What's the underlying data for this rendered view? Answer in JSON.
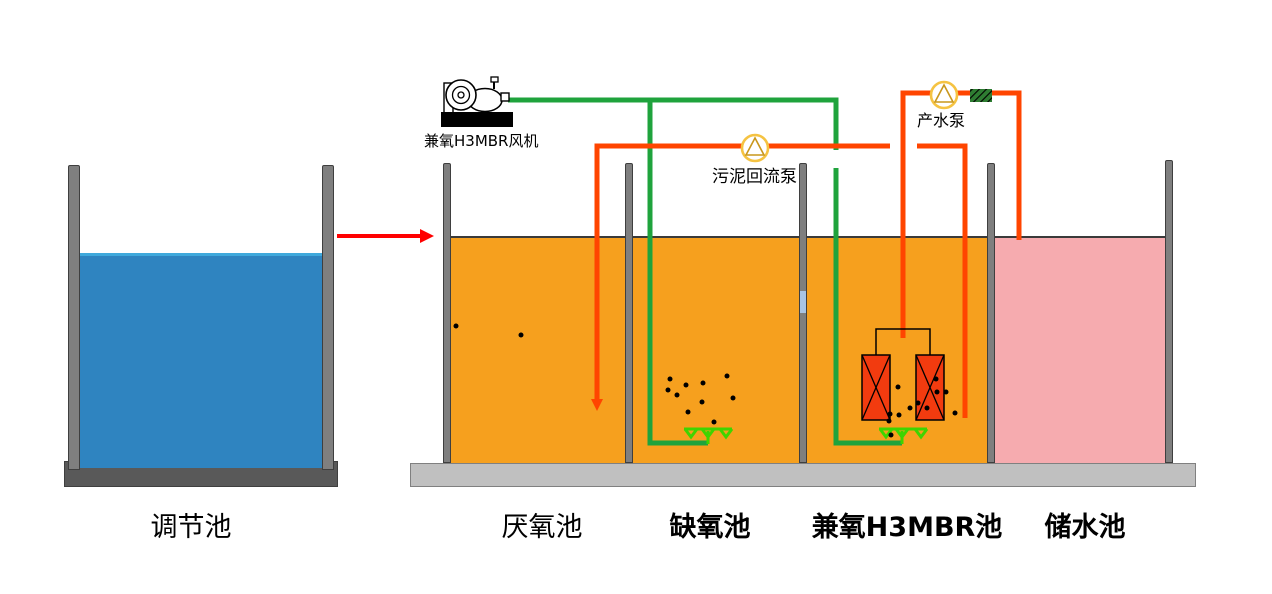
{
  "diagram_title": "兼氧H3MBR污水处理工艺流程图",
  "tanks": [
    {
      "id": "regulating",
      "label": "调节池",
      "liquid_color": "#2f84c0",
      "bold": false
    },
    {
      "id": "anaerobic",
      "label": "厌氧池",
      "liquid_color": "#f6a01e",
      "bold": false
    },
    {
      "id": "anoxic",
      "label": "缺氧池",
      "liquid_color": "#f6a01e",
      "bold": true
    },
    {
      "id": "mbr",
      "label": "兼氧H3MBR池",
      "liquid_color": "#f6a01e",
      "bold": true
    },
    {
      "id": "storage",
      "label": "储水池",
      "liquid_color": "#f6abaf",
      "bold": true
    }
  ],
  "equipment": {
    "blower": {
      "label": "兼氧H3MBR风机",
      "icon": "blower-icon"
    },
    "sludge_return_pump": {
      "label": "污泥回流泵",
      "icon": "pump-icon"
    },
    "product_water_pump": {
      "label": "产水泵",
      "icon": "pump-icon"
    },
    "valve": {
      "icon": "valve-icon"
    },
    "membrane_modules": {
      "count": 2,
      "icon": "membrane-module-icon"
    },
    "diffusers": {
      "count": 2,
      "icon": "aeration-diffuser-icon"
    }
  },
  "colors": {
    "regulating_water": "#2f84c0",
    "regulating_water_surface": "#3fa9dc",
    "process_water": "#f6a01e",
    "storage_water": "#f6abaf",
    "air_pipe": "#1fa33c",
    "diffuser_green": "#3fd400",
    "sludge_and_product_pipe": "#ff4500",
    "inflow_arrow": "#ff0000",
    "wall_gray": "#7f7f7f",
    "base_gray": "#c0c0c0",
    "regulating_base_gray": "#595959",
    "membrane_module_red": "#f23b0f",
    "pump_outline_gold": "#f5c342",
    "pump_triangle_gold": "#c9971c",
    "wall_opening_blue": "#a9c4e4"
  }
}
